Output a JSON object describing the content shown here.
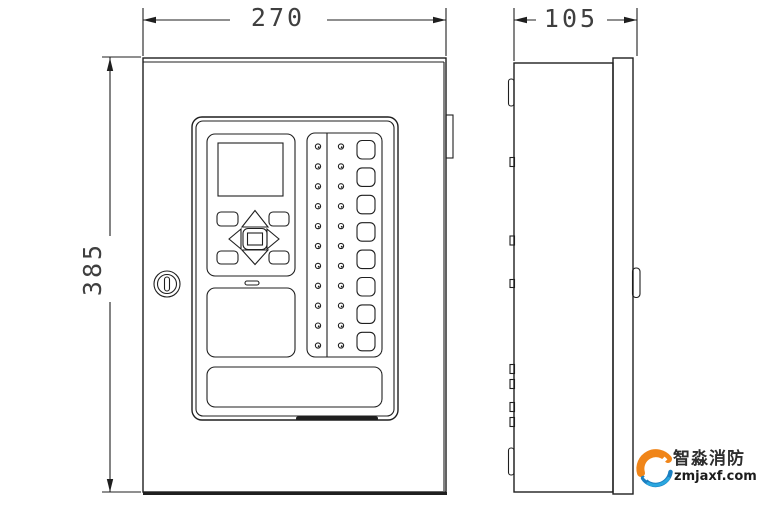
{
  "drawing": {
    "line_color": "#1f1f1f",
    "dimensions": {
      "front_width": "270",
      "side_depth": "105",
      "front_height": "385"
    },
    "front_panel": {
      "led_rows": 11,
      "led_columns": 2,
      "zone_buttons": 8
    },
    "watermark": {
      "brand_name": "智淼消防",
      "website": "zmjaxf.com",
      "colors": {
        "orange": "#f08519",
        "blue": "#1a7fc1",
        "light_blue": "#2aa7df"
      }
    }
  }
}
